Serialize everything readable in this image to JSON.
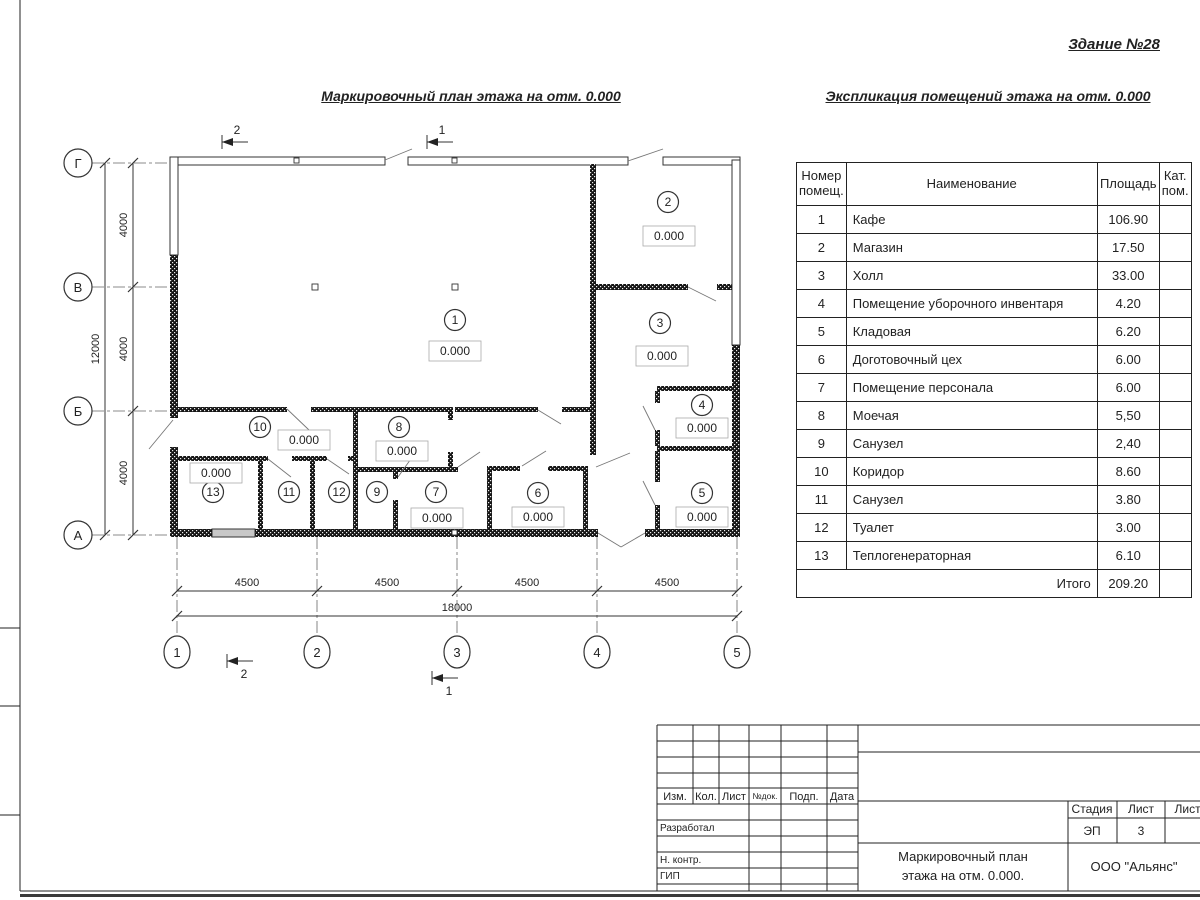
{
  "header": {
    "building": "Здание №28",
    "plan_title": "Маркировочный план этажа на отм. 0.000",
    "table_title": "Экспликация помещений этажа на отм. 0.000"
  },
  "plan": {
    "elevation": "0.000",
    "room_numbers": [
      "1",
      "2",
      "3",
      "4",
      "5",
      "6",
      "7",
      "8",
      "9",
      "10",
      "11",
      "12",
      "13"
    ],
    "grid_rows": [
      "Г",
      "В",
      "Б",
      "А"
    ],
    "grid_cols": [
      "1",
      "2",
      "3",
      "4",
      "5"
    ],
    "dim_v": [
      "4000",
      "4000",
      "4000"
    ],
    "dim_v_total": "12000",
    "dim_h": [
      "4500",
      "4500",
      "4500",
      "4500"
    ],
    "dim_h_total": "18000",
    "section_1": "1",
    "section_2": "2"
  },
  "table": {
    "col_headers": [
      "Номер помещ.",
      "Наименование",
      "Площадь",
      "Кат. пом."
    ],
    "rows": [
      {
        "num": "1",
        "name": "Кафе",
        "area": "106.90",
        "cat": ""
      },
      {
        "num": "2",
        "name": "Магазин",
        "area": "17.50",
        "cat": ""
      },
      {
        "num": "3",
        "name": "Холл",
        "area": "33.00",
        "cat": ""
      },
      {
        "num": "4",
        "name": "Помещение уборочного инвентаря",
        "area": "4.20",
        "cat": ""
      },
      {
        "num": "5",
        "name": "Кладовая",
        "area": "6.20",
        "cat": ""
      },
      {
        "num": "6",
        "name": "Доготовочный цех",
        "area": "6.00",
        "cat": ""
      },
      {
        "num": "7",
        "name": "Помещение персонала",
        "area": "6.00",
        "cat": ""
      },
      {
        "num": "8",
        "name": "Моечая",
        "area": "5,50",
        "cat": ""
      },
      {
        "num": "9",
        "name": "Санузел",
        "area": "2,40",
        "cat": ""
      },
      {
        "num": "10",
        "name": "Коридор",
        "area": "8.60",
        "cat": ""
      },
      {
        "num": "11",
        "name": "Санузел",
        "area": "3.80",
        "cat": ""
      },
      {
        "num": "12",
        "name": "Туалет",
        "area": "3.00",
        "cat": ""
      },
      {
        "num": "13",
        "name": "Теплогенераторная",
        "area": "6.10",
        "cat": ""
      }
    ],
    "total_label": "Итого",
    "total_area": "209.20"
  },
  "titleblock": {
    "columns": [
      "Изм.",
      "Кол.",
      "Лист",
      "№док.",
      "Подп.",
      "Дата"
    ],
    "rows": [
      "Разработал",
      "Н. контр.",
      "ГИП"
    ],
    "stage_label": "Стадия",
    "sheet_label": "Лист",
    "sheets_label": "Листов",
    "stage_value": "ЭП",
    "sheet_value": "3",
    "doc_title_line1": "Маркировочный план",
    "doc_title_line2": "этажа на отм. 0.000.",
    "company": "ООО \"Альянс\""
  },
  "colors": {
    "ink": "#222222",
    "wall": "#161616",
    "frame_bottom": "#3a3a3a"
  }
}
